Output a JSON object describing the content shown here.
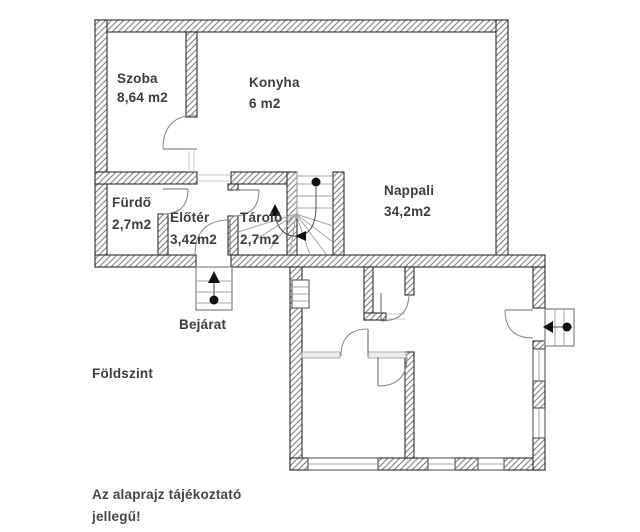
{
  "plan": {
    "floor_label": "Földszint",
    "entrance_label": "Bejárat",
    "disclaimer": {
      "line1": "Az alaprajz tájékoztató",
      "line2": "jellegű!"
    },
    "rooms": [
      {
        "id": "szoba",
        "name": "Szoba",
        "area": "8,64 m2"
      },
      {
        "id": "konyha",
        "name": "Konyha",
        "area": "6 m2"
      },
      {
        "id": "furdo",
        "name": "Fürdő",
        "area": "2,7m2"
      },
      {
        "id": "eloter",
        "name": "Előtér",
        "area": "3,42m2"
      },
      {
        "id": "tarolo",
        "name": "Tároló",
        "area": "2,7m2"
      },
      {
        "id": "nappali",
        "name": "Nappali",
        "area": "34,2m2"
      }
    ],
    "colors": {
      "background": "#ffffff",
      "wall_outline": "#2e2e2e",
      "hatch": "#7d7d7d",
      "room_text": "#3d3d3d",
      "note_text": "#42474e",
      "stairs": "#a6a6a6",
      "door_arc": "#8d8d8d",
      "marker": "#111111"
    }
  }
}
